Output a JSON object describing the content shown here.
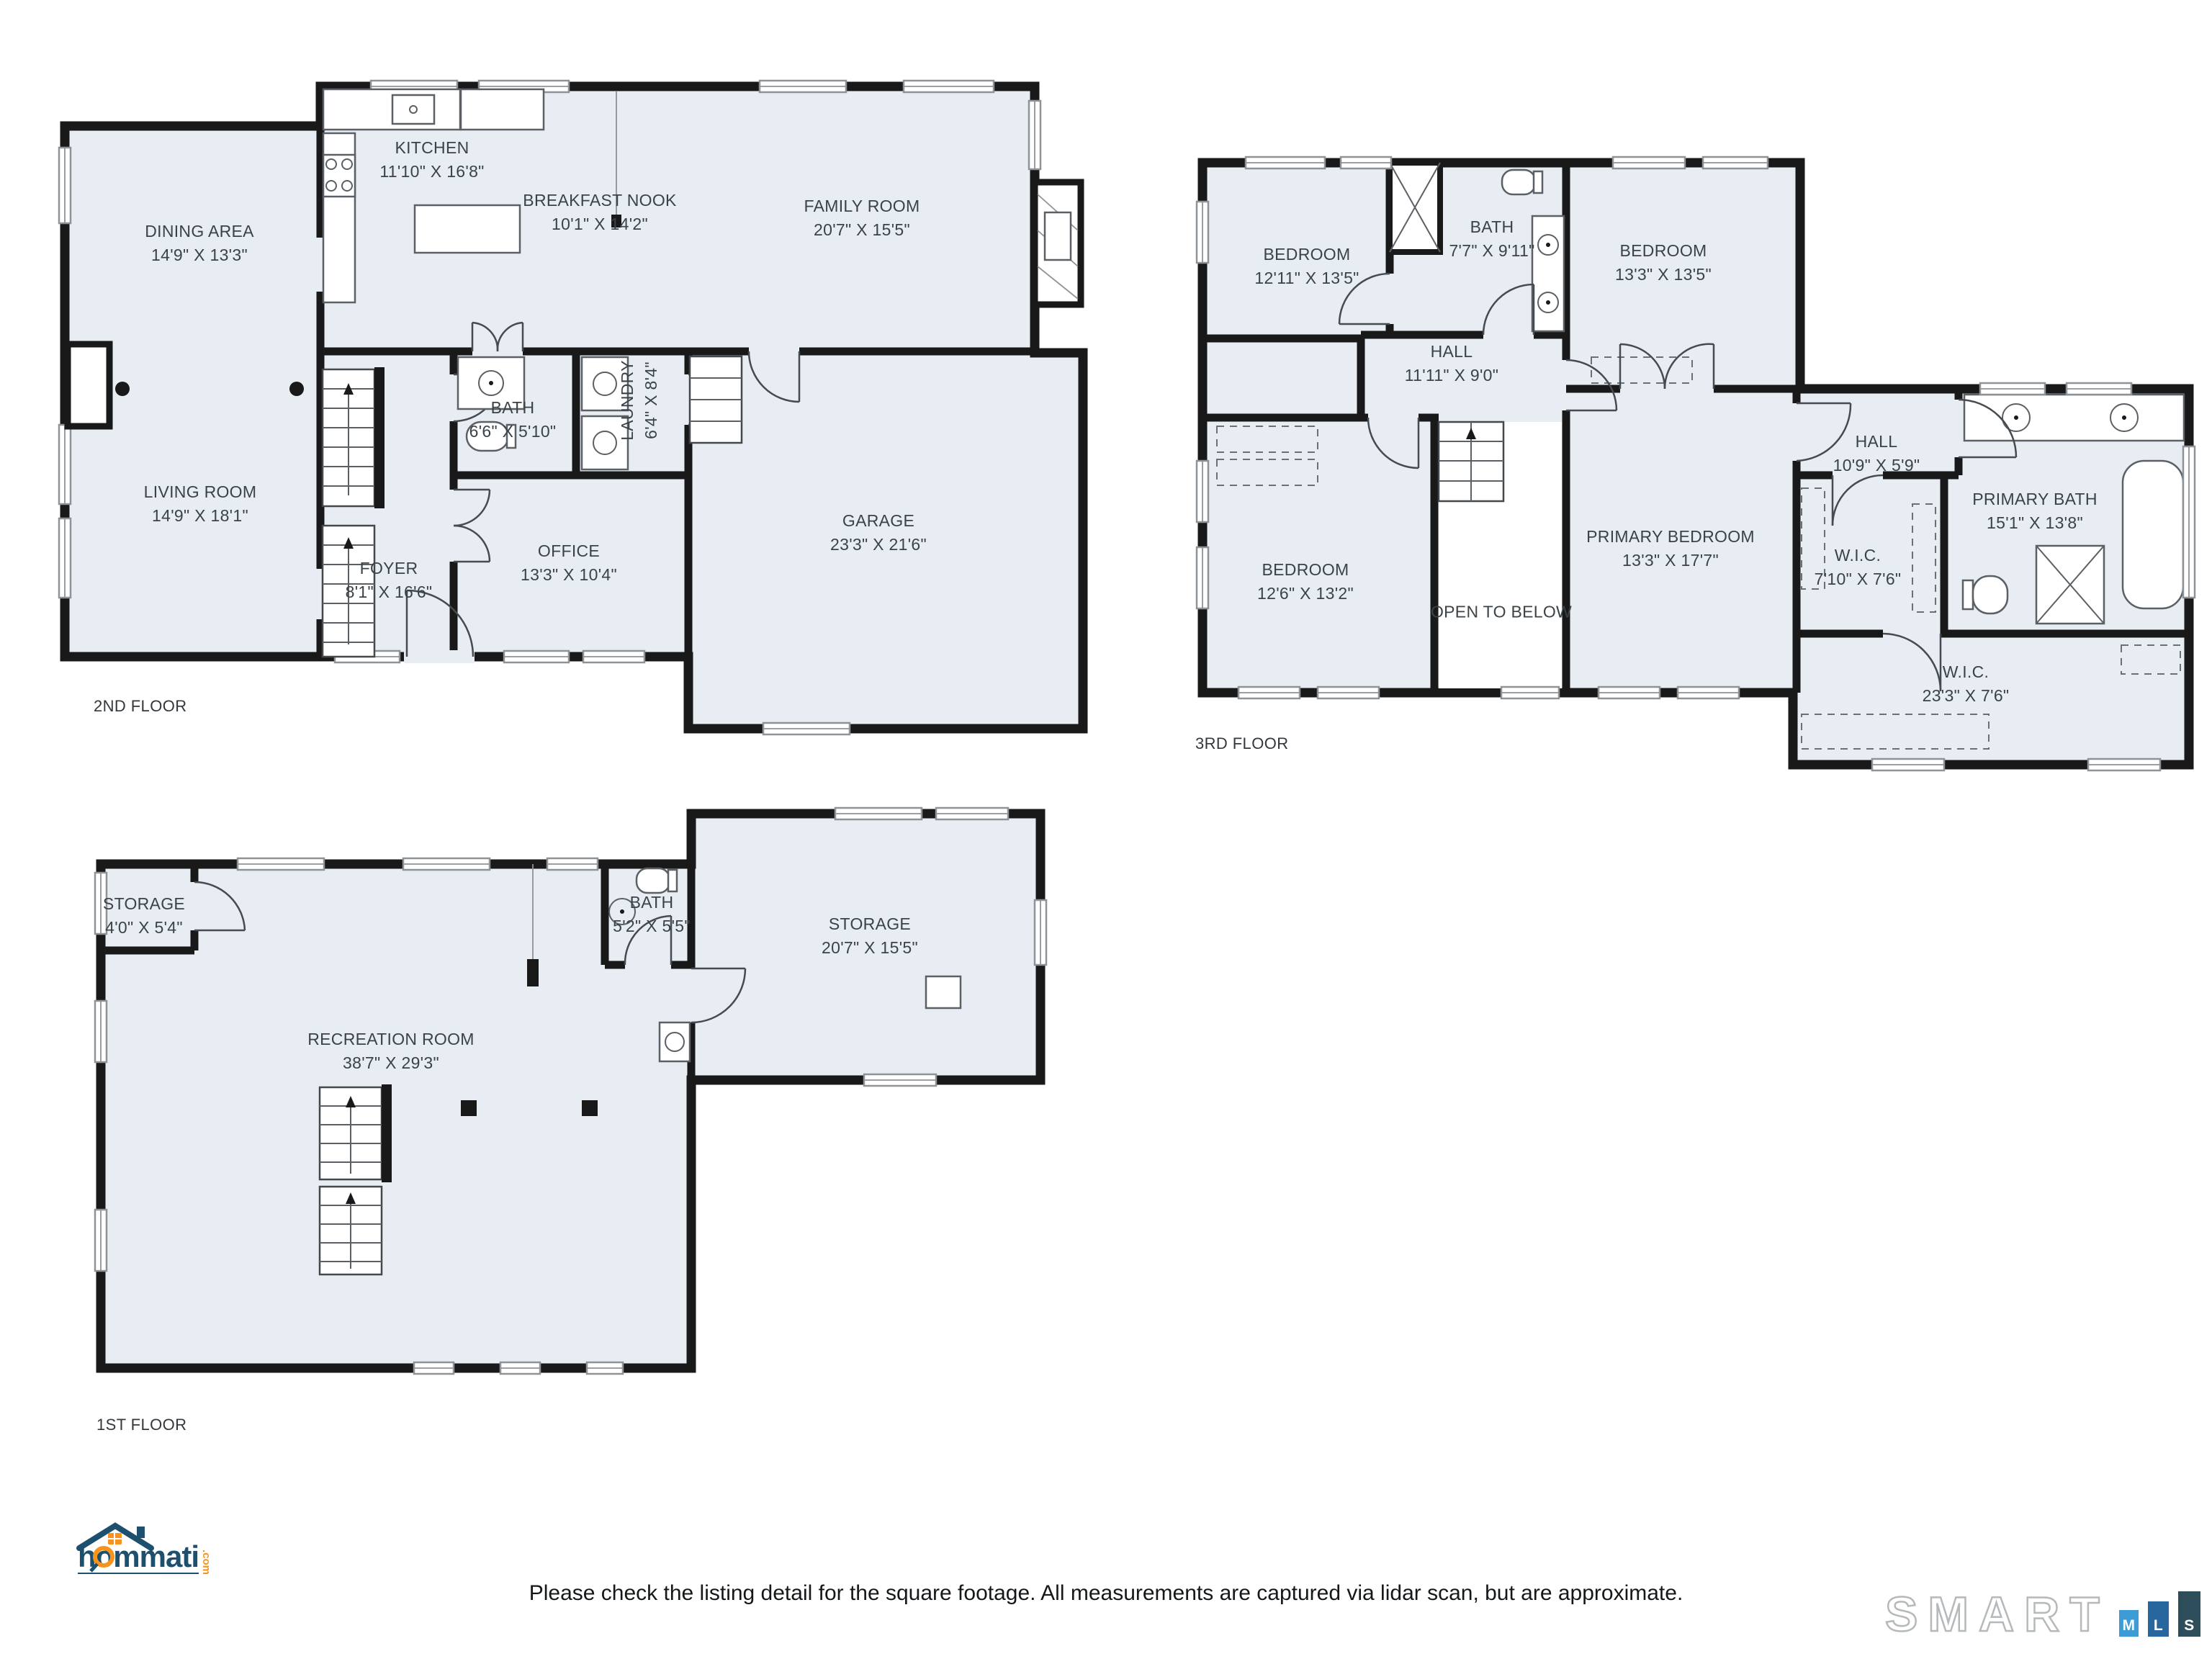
{
  "floors": [
    {
      "label": "2ND FLOOR",
      "rooms": [
        {
          "name": "DINING AREA",
          "dims": "14'9\" X 13'3\""
        },
        {
          "name": "KITCHEN",
          "dims": "11'10\" X 16'8\""
        },
        {
          "name": "BREAKFAST NOOK",
          "dims": "10'1\" X 14'2\""
        },
        {
          "name": "FAMILY ROOM",
          "dims": "20'7\" X 15'5\""
        },
        {
          "name": "LIVING ROOM",
          "dims": "14'9\" X 18'1\""
        },
        {
          "name": "BATH",
          "dims": "6'6\" X 5'10\""
        },
        {
          "name": "LAUNDRY",
          "dims": "6'4\" X 8'4\""
        },
        {
          "name": "FOYER",
          "dims": "8'1\" X 16'6\""
        },
        {
          "name": "OFFICE",
          "dims": "13'3\" X 10'4\""
        },
        {
          "name": "GARAGE",
          "dims": "23'3\" X 21'6\""
        }
      ]
    },
    {
      "label": "3RD FLOOR",
      "rooms": [
        {
          "name": "BEDROOM",
          "dims": "12'11\" X 13'5\""
        },
        {
          "name": "BATH",
          "dims": "7'7\" X 9'11\""
        },
        {
          "name": "BEDROOM",
          "dims": "13'3\" X 13'5\""
        },
        {
          "name": "HALL",
          "dims": "11'11\" X 9'0\""
        },
        {
          "name": "BEDROOM",
          "dims": "12'6\" X 13'2\""
        },
        {
          "name": "PRIMARY BEDROOM",
          "dims": "13'3\" X 17'7\""
        },
        {
          "name": "OPEN TO BELOW",
          "dims": ""
        },
        {
          "name": "HALL",
          "dims": "10'9\" X 5'9\""
        },
        {
          "name": "W.I.C.",
          "dims": "7'10\" X 7'6\""
        },
        {
          "name": "PRIMARY BATH",
          "dims": "15'1\" X 13'8\""
        },
        {
          "name": "W.I.C.",
          "dims": "23'3\" X 7'6\""
        }
      ]
    },
    {
      "label": "1ST FLOOR",
      "rooms": [
        {
          "name": "STORAGE",
          "dims": "4'0\" X 5'4\""
        },
        {
          "name": "BATH",
          "dims": "5'2\" X 5'5\""
        },
        {
          "name": "STORAGE",
          "dims": "20'7\" X 15'5\""
        },
        {
          "name": "RECREATION ROOM",
          "dims": "38'7\" X 29'3\""
        }
      ]
    }
  ],
  "footer": {
    "disclaimer": "Please check the listing detail for the square footage. All measurements are captured via lidar scan, but are approximate."
  },
  "branding": {
    "hommati": {
      "name": "hommati",
      "suffix": ".com"
    },
    "smartmls": {
      "word": "SMART",
      "m": "M",
      "l": "L",
      "s": "S"
    }
  },
  "colors": {
    "floor_fill": "#e7edf2",
    "wall": "#191919",
    "hommati_navy": "#1d4f6e",
    "hommati_orange": "#f7941e",
    "mls_m": "#3d9bd5",
    "mls_l": "#27679e",
    "mls_s": "#2e4d5b"
  }
}
